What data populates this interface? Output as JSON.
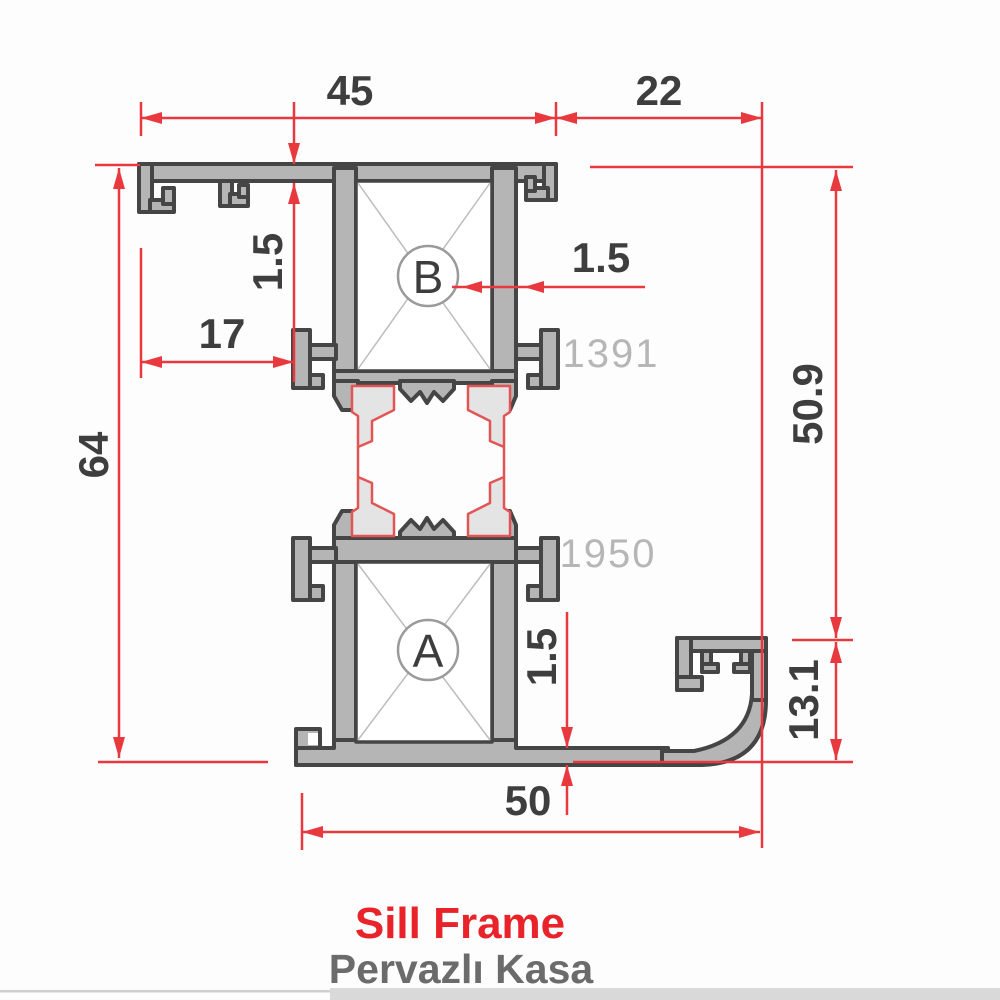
{
  "drawing": {
    "kind": "aluminum-profile-cross-section",
    "title": {
      "primary": "Sill Frame",
      "secondary": "Pervazlı Kasa"
    },
    "profile_codes": {
      "top": "1391",
      "bottom": "1950"
    },
    "chambers": {
      "top": "B",
      "bottom": "A"
    },
    "dimensions": {
      "top_left_width": "45",
      "top_right_width": "22",
      "top_wall_thickness": "1.5",
      "hook_offset": "17",
      "overall_height": "64",
      "chamber_wall_thickness": "1.5",
      "right_upper_height": "50.9",
      "nose_height": "13.1",
      "bottom_wall_thickness": "1.5",
      "bottom_width": "50"
    },
    "colors": {
      "dimension_red": "#e8393f",
      "profile_fill": "#b5b5b5",
      "profile_outline": "#454545",
      "insulator_fill": "#e4e4e4",
      "insulator_outline": "#e25555",
      "code_gray": "#b6b6b6",
      "dim_text": "#3e3e3e",
      "title_red": "#e8232a",
      "subtitle_gray": "#6b6b6b"
    }
  }
}
